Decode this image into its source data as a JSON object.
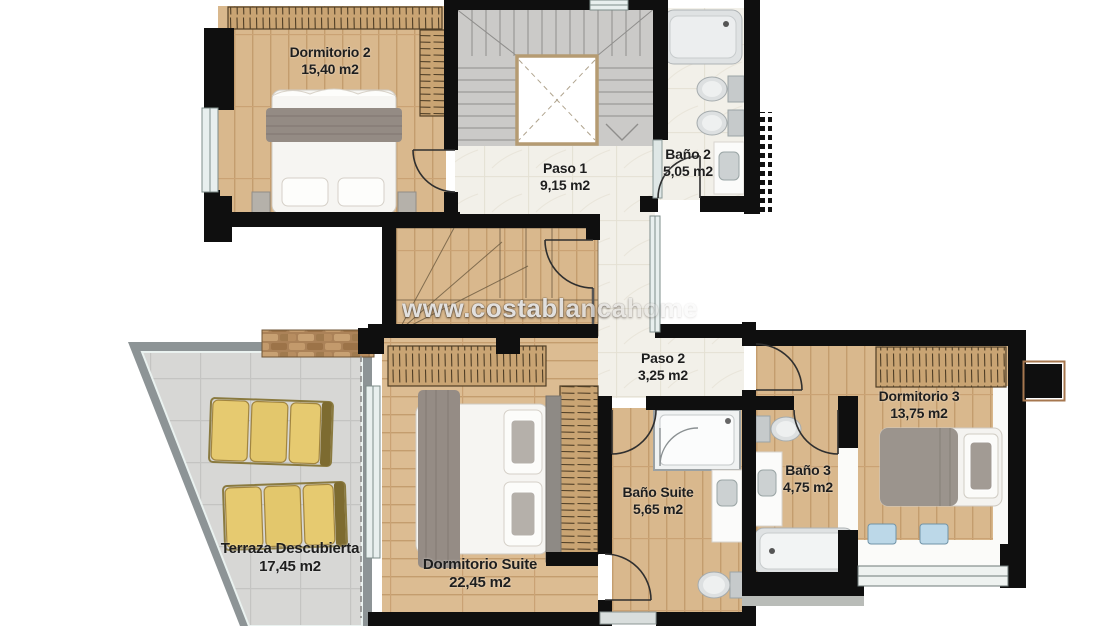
{
  "plan": {
    "watermark": "www.costablancahome",
    "rooms": [
      {
        "name": "Dormitorio 2",
        "area": "15,40 m2"
      },
      {
        "name": "Paso 1",
        "area": "9,15 m2"
      },
      {
        "name": "Baño 2",
        "area": "5,05 m2"
      },
      {
        "name": "Paso 2",
        "area": "3,25 m2"
      },
      {
        "name": "Dormitorio 3",
        "area": "13,75 m2"
      },
      {
        "name": "Baño Suite",
        "area": "5,65 m2"
      },
      {
        "name": "Baño 3",
        "area": "4,75 m2"
      },
      {
        "name": "Terraza Descubierta",
        "area": "17,45 m2"
      },
      {
        "name": "Dormitorio Suite",
        "area": "22,45 m2"
      }
    ],
    "colors": {
      "wall": "#0f0f0f",
      "wood_floor": "#d9b88d",
      "pale_tile": "#f2f0e9",
      "terrace_tile": "#d7d7d5",
      "stairs": "#cbcac8",
      "lounger": "#e6ca70",
      "stone": "#ab8258",
      "label_text": "#1e1e1e"
    }
  }
}
